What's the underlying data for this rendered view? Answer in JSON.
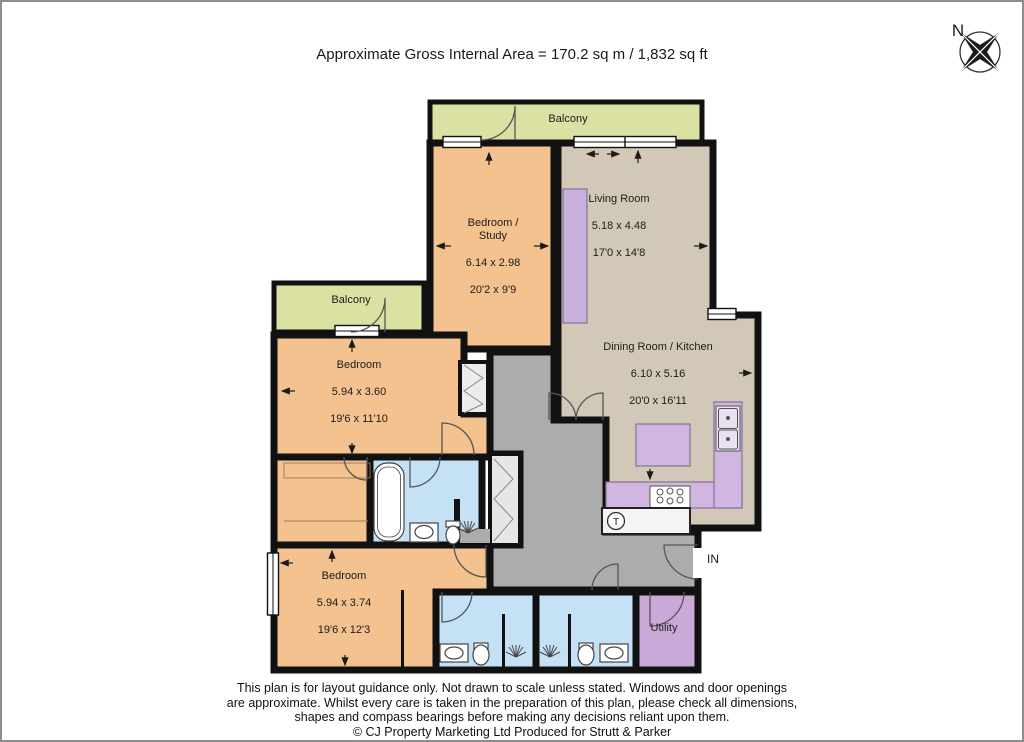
{
  "title": "Approximate Gross Internal Area = 170.2 sq m / 1,832 sq ft",
  "compass": {
    "north_label": "N"
  },
  "rooms": {
    "balcony_top": {
      "label": "Balcony"
    },
    "balcony_left": {
      "label": "Balcony"
    },
    "bedroom_study": {
      "label": "Bedroom /\nStudy",
      "dims_metric": "6.14 x 2.98",
      "dims_imperial": "20'2 x 9'9"
    },
    "living_room": {
      "label": "Living Room",
      "dims_metric": "5.18 x 4.48",
      "dims_imperial": "17'0 x 14'8"
    },
    "dining_kitchen": {
      "label": "Dining Room / Kitchen",
      "dims_metric": "6.10 x 5.16",
      "dims_imperial": "20'0 x 16'11"
    },
    "bedroom_mid": {
      "label": "Bedroom",
      "dims_metric": "5.94 x 3.60",
      "dims_imperial": "19'6 x 11'10"
    },
    "bedroom_bottom": {
      "label": "Bedroom",
      "dims_metric": "5.94 x 3.74",
      "dims_imperial": "19'6 x 12'3"
    },
    "utility": {
      "label": "Utility"
    }
  },
  "markers": {
    "entrance": "IN",
    "tank": "T"
  },
  "colors": {
    "bedroom": "#F3C28E",
    "living_dining": "#D2C8B8",
    "balcony": "#DAE1A2",
    "bathroom": "#C4E1F6",
    "utility": "#C9A9D8",
    "kitchen_fixture": "#D0B6E0",
    "hallway": "#ACACAC",
    "wall": "#111111"
  },
  "footer": {
    "disclaimer": "This plan is for layout guidance only. Not drawn to scale unless stated. Windows and door openings\nare approximate. Whilst every care is taken in the preparation of this plan, please check all dimensions,\nshapes and compass bearings before making any decisions reliant upon them.",
    "copyright": "© CJ Property Marketing Ltd Produced for Strutt & Parker"
  }
}
